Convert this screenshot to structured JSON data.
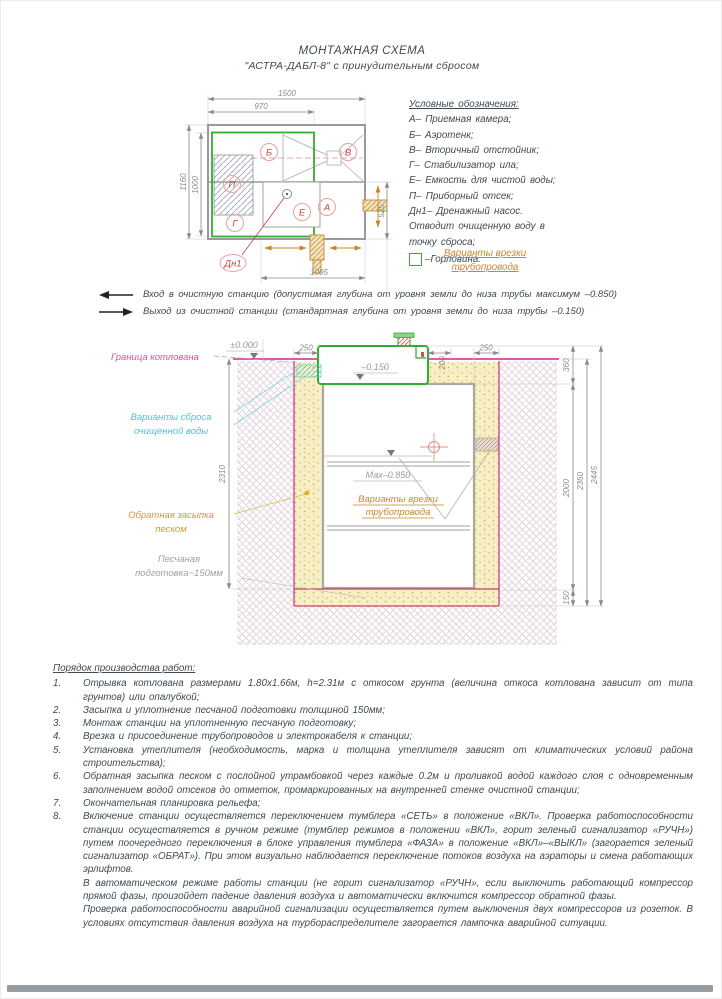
{
  "page": {
    "title_line1": "МОНТАЖНАЯ СХЕМА",
    "title_line2": "\"АСТРА-ДАБЛ-8\" с принудительным сбросом"
  },
  "plan": {
    "letters": {
      "b": "Б",
      "v": "В",
      "p": "П",
      "g": "Г",
      "e": "Е",
      "a": "А",
      "dn1": "Дн1"
    },
    "dims": {
      "w1500": "1500",
      "w970": "970",
      "h1160": "1160",
      "h1000": "1000",
      "h525": "525",
      "w1005": "1005"
    }
  },
  "legend": {
    "title": "Условные обозначения:",
    "items": [
      "А– Приемная камера;",
      "Б– Аэротенк;",
      "В– Вторичный отстойник;",
      "Г– Стабилизатор ила;",
      "Е– Емкость для чистой воды;",
      "П– Приборный отсек;",
      "Дн1– Дренажный насос.",
      "Отводит очищенную воду в",
      "точку сброса;"
    ],
    "gorlovina": "–Горловина.",
    "tapin_line1": "Варианты врезки",
    "tapin_line2": "трубопровода"
  },
  "notes": {
    "inlet": "Вход в очистную станцию (допустимая глубина от уровня земли до низа трубы максимум –0.850)",
    "outlet": "Выход из очистной станции (стандартная глубина от уровня земли до низа трубы –0.150)"
  },
  "section": {
    "labels": {
      "pit_boundary": "Граница котлована",
      "discharge_line1": "Варианты сброса",
      "discharge_line2": "очищенной воды",
      "backfill_line1": "Обратная засыпка",
      "backfill_line2": "песком",
      "sand_line1": "Песчаная",
      "sand_line2": "подготовка~150мм",
      "tapin_line1": "Варианты врезки",
      "tapin_line2": "трубопровода"
    },
    "levels": {
      "zero": "±0.000",
      "top": "–0.150",
      "max": "Мах–0.850"
    },
    "dims": {
      "left250": "250",
      "v200": "200",
      "right250": "250",
      "v360": "360",
      "v2445": "2445",
      "v2360": "2360",
      "v2000": "2000",
      "v150": "150",
      "h2310": "2310"
    }
  },
  "procedure": {
    "title": "Порядок производства работ:",
    "items": [
      {
        "num": "1.",
        "text": "Отрывка котлована размерами 1.80х1.66м, h=2.31м с откосом грунта (величина откоса котлована зависит от типа грунтов) или опалубкой;"
      },
      {
        "num": "2.",
        "text": "Засыпка и уплотнение песчаной подготовки толщиной 150мм;"
      },
      {
        "num": "3.",
        "text": "Монтаж станции на уплотненную песчаную подготовку;"
      },
      {
        "num": "4.",
        "text": "Врезка и присоединение трубопроводов и электрокабеля к станции;"
      },
      {
        "num": "5.",
        "text": "Установка утеплителя (необходимость, марка и толщина утеплителя зависят от климатических условий района строительства);"
      },
      {
        "num": "6.",
        "text": "Обратная засыпка песком с послойной утрамбовкой через каждые 0.2м и проливкой водой каждого слоя с одновременным заполнением водой отсеков до отметок, промаркированных на внутренней стенке очистной станции;"
      },
      {
        "num": "7.",
        "text": "Окончательная планировка рельефа;"
      },
      {
        "num": "8.",
        "text": "Включение станции осуществляется переключением тумблера «СЕТЬ» в положение «ВКЛ». Проверка работоспособности станции осуществляется в ручном режиме (тумблер режимов в положении «ВКЛ», горит зеленый сигнализатор «РУЧН») путем поочередного переключения в блоке управления тумблера «ФАЗА»  в положение «ВКЛ»–«ВЫКЛ» (загорается зеленый сигнализатор «ОБРАТ»).  При этом визуально наблюдается переключение потоков воздуха на аэраторы и смена работающих эрлифтов."
      }
    ],
    "paragraphs": [
      "В автоматическом режиме работы станции (не горит сигнализатор «РУЧН», если выключить работающий компрессор прямой фазы, произойдет падение давления воздуха и автоматически включится компрессор обратной фазы.",
      "Проверка работоспособности аварийной сигнализации осуществляется путем выключения двух компрессоров из розеток. В условиях  отсутствия давления воздуха на турбораспределителе загорается лампочка аварийной ситуации."
    ]
  },
  "colors": {
    "green": "#2fae2f",
    "magenta": "#d0479d",
    "red": "#c94444",
    "cyan": "#4cc4cc",
    "orange": "#c8882a",
    "dim_gray": "#8a8a8a",
    "text": "#3d4a50"
  }
}
